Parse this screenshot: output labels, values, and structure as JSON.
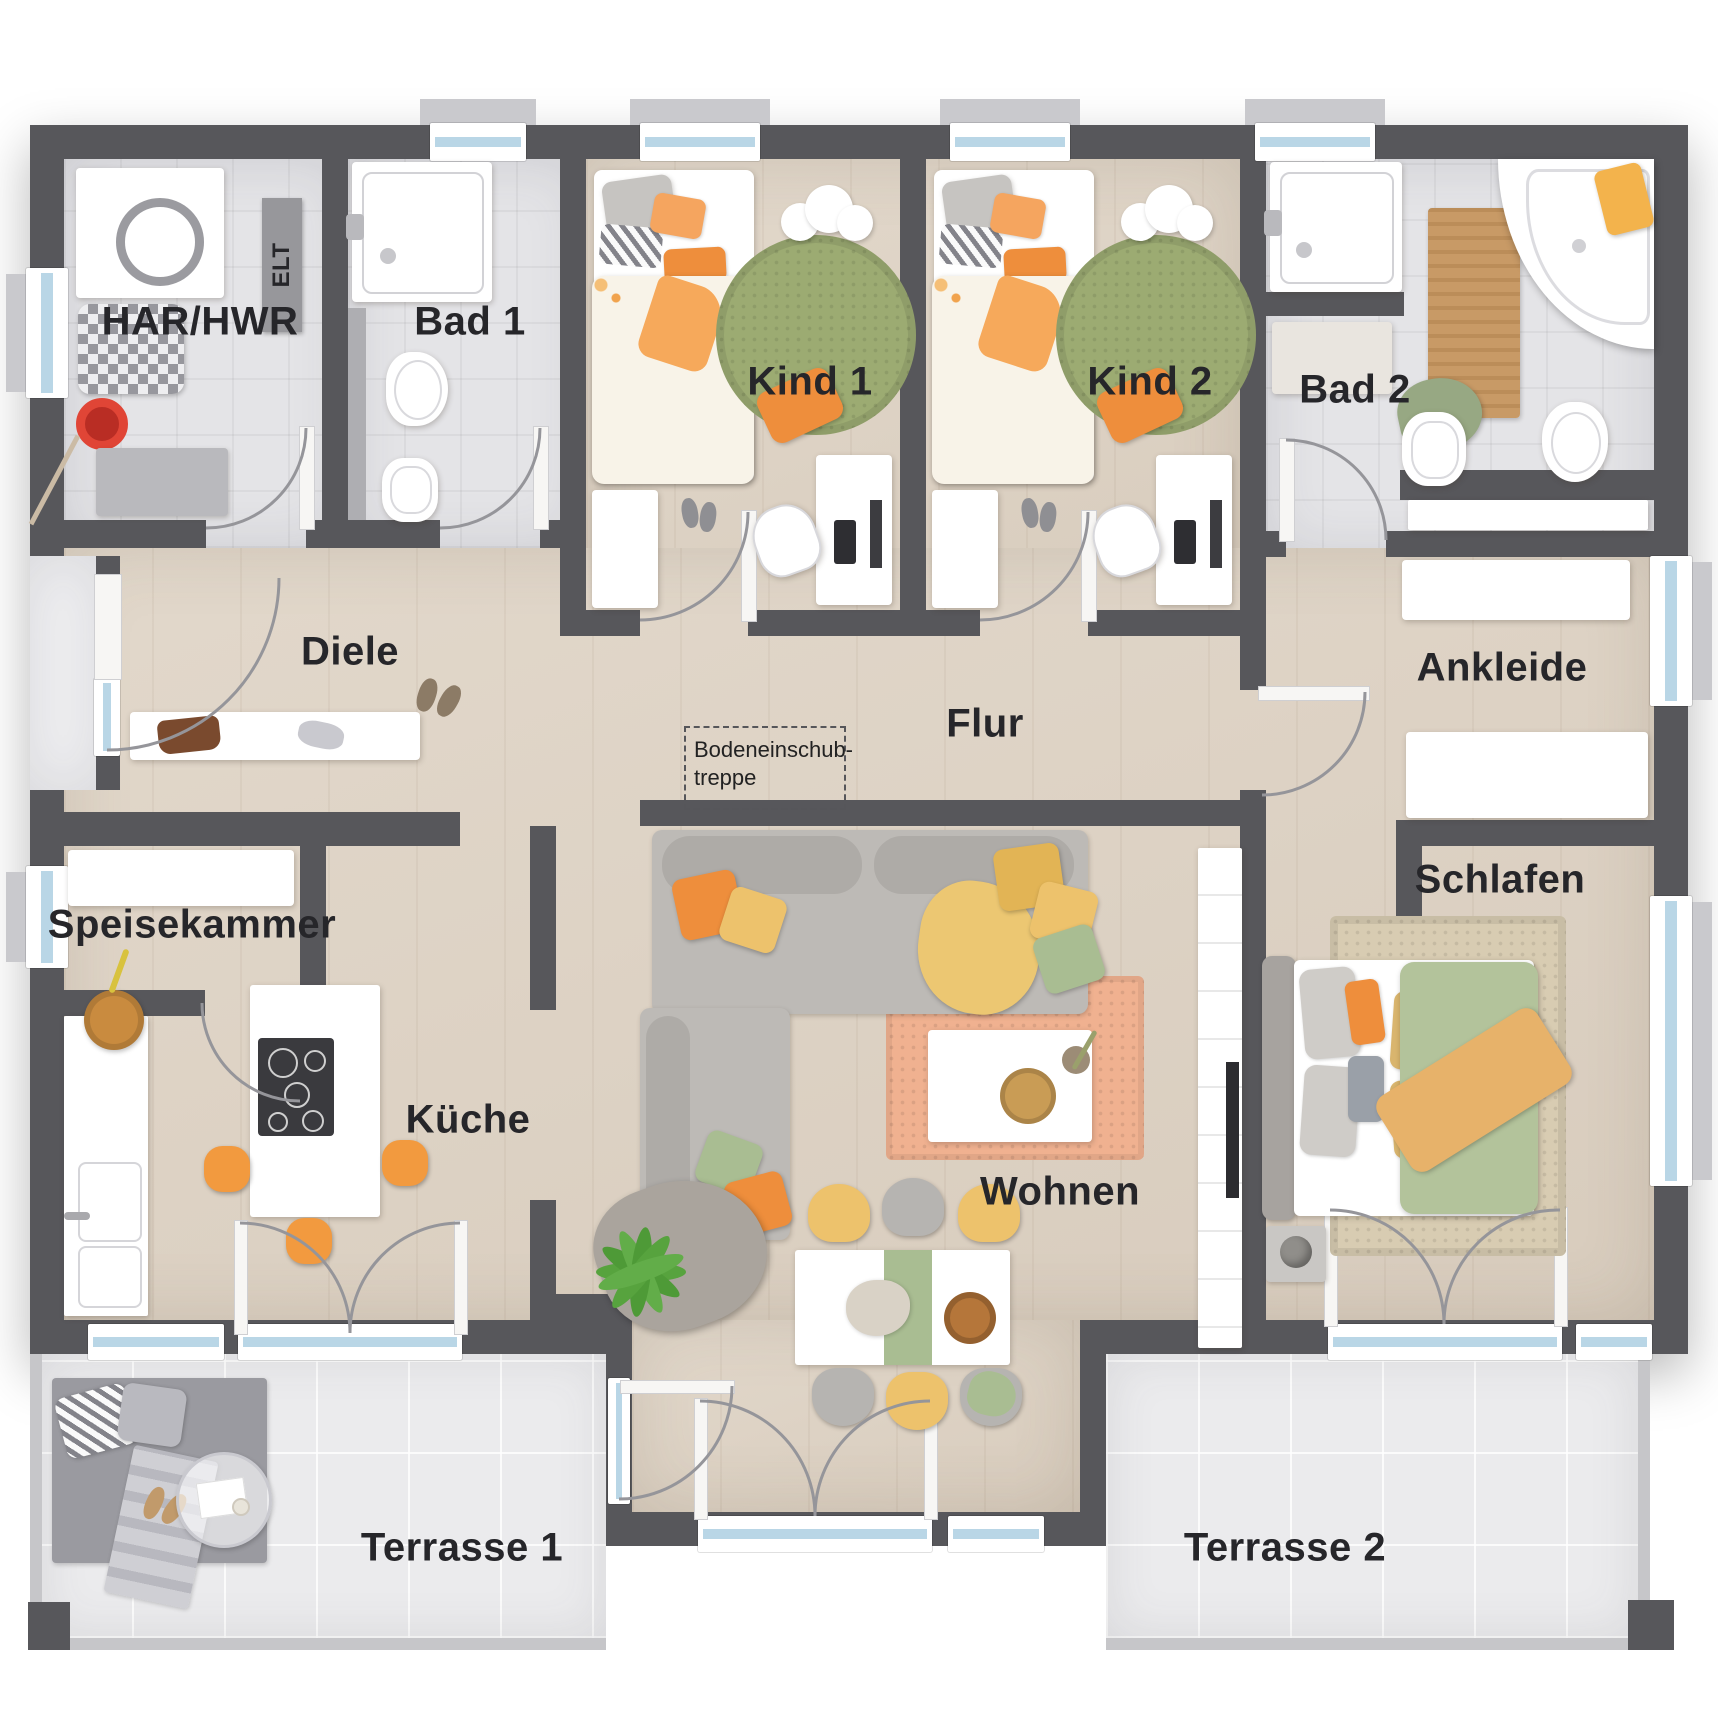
{
  "colors": {
    "wall": "#57575b",
    "wood": "#ddd2c3",
    "tile": "#e4e4e7",
    "terrace": "#ebebed",
    "glass": "#b9d6e6",
    "orange": "#ee8e3c",
    "yellow": "#edc26c",
    "sage": "#a9bd92",
    "ruggreen": "#9cab72",
    "rugpeach": "#f0b190",
    "rugbeige": "#d8ccb2",
    "grayfurn": "#b9b9bd",
    "ink": "#26262a"
  },
  "rooms": {
    "har": {
      "label": "HAR/HWR"
    },
    "elt": {
      "label": "ELT"
    },
    "bad1": {
      "label": "Bad 1"
    },
    "kind1": {
      "label": "Kind 1"
    },
    "kind2": {
      "label": "Kind 2"
    },
    "bad2": {
      "label": "Bad 2"
    },
    "diele": {
      "label": "Diele"
    },
    "flur": {
      "label": "Flur"
    },
    "ankleide": {
      "label": "Ankleide"
    },
    "speisekammer": {
      "label": "Speisekammer"
    },
    "kueche": {
      "label": "Küche"
    },
    "wohnen": {
      "label": "Wohnen"
    },
    "schlafen": {
      "label": "Schlafen"
    },
    "terrasse1": {
      "label": "Terrasse 1"
    },
    "terrasse2": {
      "label": "Terrasse 2"
    }
  },
  "annotations": {
    "attic_stairs_line1": "Bodeneinschub-",
    "attic_stairs_line2": "treppe"
  }
}
